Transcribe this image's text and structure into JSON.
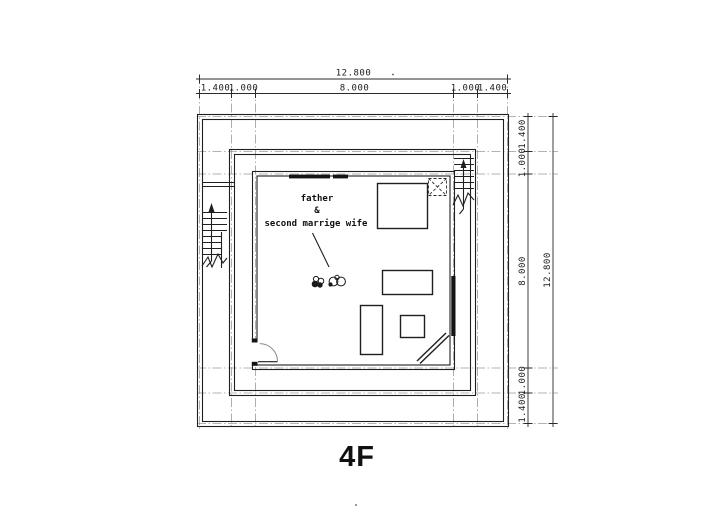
{
  "drawing": {
    "floor_label": "4F",
    "room_note": {
      "line1": "father",
      "line2": "&",
      "line3": "second marrige wife"
    }
  },
  "dimensions": {
    "top": {
      "total": "12.800",
      "segments": [
        "1.400",
        "1.000",
        "8.000",
        "1.000",
        "1.400"
      ]
    },
    "right": {
      "total": "12.800",
      "segments": [
        "1.400",
        "1.000",
        "8.000",
        "1.000",
        "1.400"
      ]
    }
  },
  "colors": {
    "ink": "#1f1f1f",
    "centerline": "#9a9a9a",
    "background": "#ffffff"
  }
}
